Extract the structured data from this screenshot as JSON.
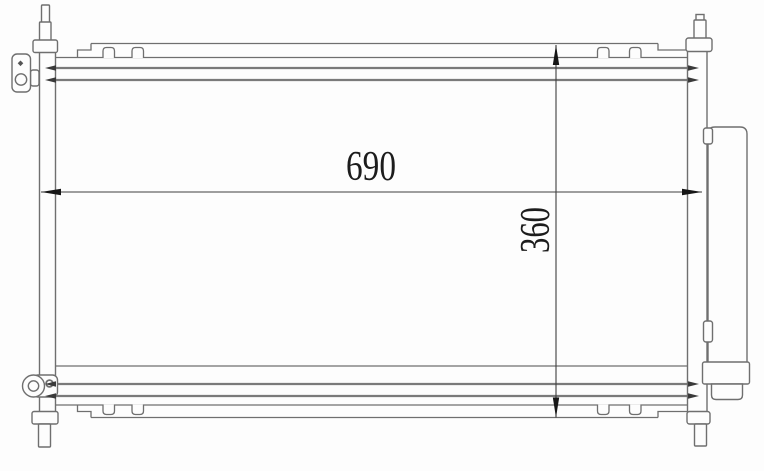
{
  "drawing": {
    "dim_width": "690",
    "dim_height": "360"
  },
  "colors": {
    "background": "#fdfdfd",
    "outline": "#6f6f6f",
    "tube_line": "#7a7a7a",
    "dimension": "#1c1c1c"
  }
}
